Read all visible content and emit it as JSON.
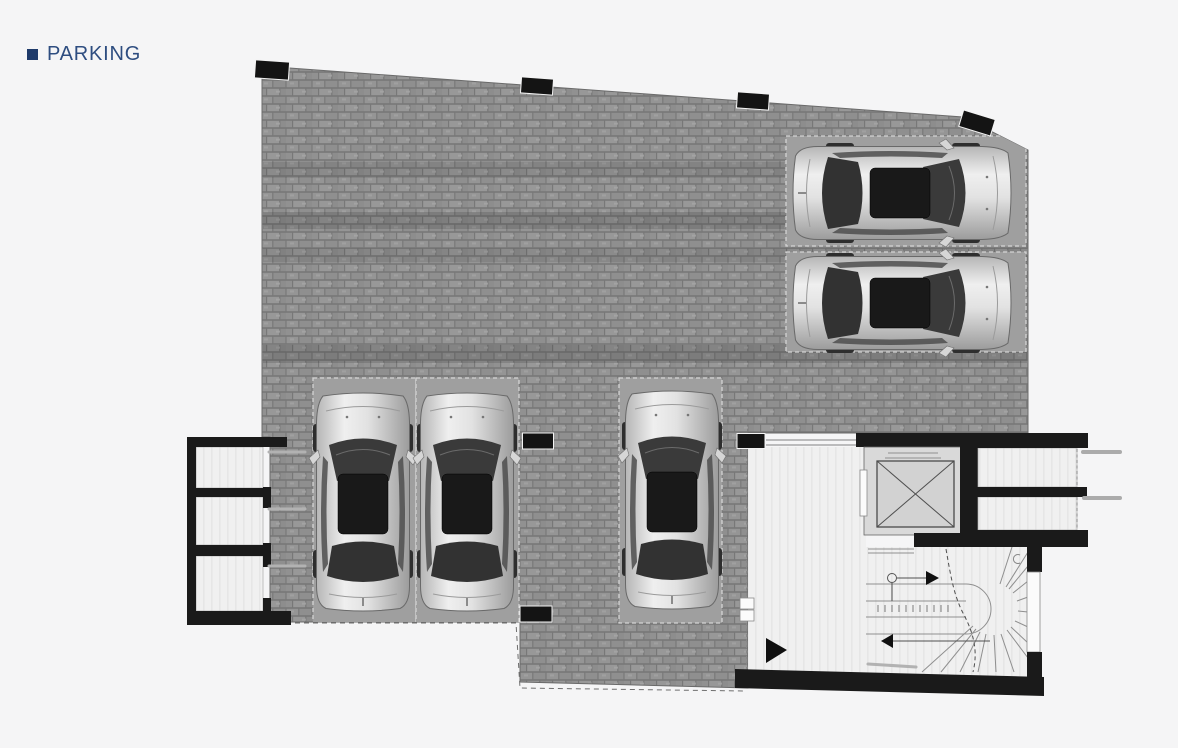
{
  "page": {
    "background": "#f5f5f6",
    "header": {
      "title": "PARKING",
      "bullet_color": "#1e3a6a",
      "title_color": "#2e4d80"
    }
  },
  "plan": {
    "type": "architectural-floor-plan",
    "level_label": "PARKING",
    "counts": {
      "cars": 5,
      "parking_stalls": 5,
      "storage_rooms_left": 3,
      "rooms_right": 2,
      "columns": 7
    },
    "features": [
      "cobblestone paved courtyard",
      "parking stalls",
      "elevator shaft",
      "winder staircase",
      "entrance lobby",
      "storage rooms"
    ],
    "colors": {
      "paving": "#8d8d8d",
      "paving_joint": "#787878",
      "stall_fill": "#9f9f9f",
      "wall_black": "#1a1a1a",
      "room_fill": "#f0f0f0",
      "elevator_fill": "#d9d9d9",
      "line_gray": "#8f8f8f",
      "page_bg": "#f5f5f6"
    },
    "paving": {
      "outline": [
        [
          262,
          66
        ],
        [
          963,
          117
        ],
        [
          1028,
          150
        ],
        [
          1028,
          433
        ],
        [
          748,
          433
        ],
        [
          748,
          688
        ],
        [
          520,
          682
        ],
        [
          520,
          622
        ],
        [
          270,
          622
        ],
        [
          270,
          437
        ],
        [
          262,
          437
        ]
      ],
      "bands": [
        [
          263,
          162,
          764,
          16,
          0.1
        ],
        [
          263,
          212,
          764,
          17,
          0.17
        ],
        [
          263,
          248,
          764,
          14,
          0.1
        ],
        [
          263,
          345,
          764,
          18,
          0.17
        ]
      ],
      "boundary_dashes": "268,623 516,623 520,688 744,691"
    },
    "stalls": [
      [
        786,
        136,
        240,
        110
      ],
      [
        786,
        252,
        240,
        100
      ],
      [
        313,
        378,
        103,
        245
      ],
      [
        416,
        378,
        103,
        245
      ],
      [
        619,
        378,
        103,
        245
      ]
    ],
    "columns": [
      [
        272,
        70,
        34,
        18,
        4
      ],
      [
        537,
        86,
        32,
        16,
        4
      ],
      [
        753,
        101,
        32,
        16,
        4
      ],
      [
        977,
        123,
        33,
        17,
        17
      ],
      [
        538,
        441,
        31,
        16,
        0
      ],
      [
        751,
        441,
        28,
        15,
        0
      ],
      [
        536,
        614,
        32,
        16,
        0
      ]
    ],
    "cars": [
      {
        "cx": 902,
        "cy": 193,
        "rot": 90
      },
      {
        "cx": 902,
        "cy": 303,
        "rot": 90
      },
      {
        "cx": 363,
        "cy": 502,
        "rot": 0
      },
      {
        "cx": 467,
        "cy": 502,
        "rot": 0
      },
      {
        "cx": 672,
        "cy": 500,
        "rot": 0
      }
    ]
  }
}
